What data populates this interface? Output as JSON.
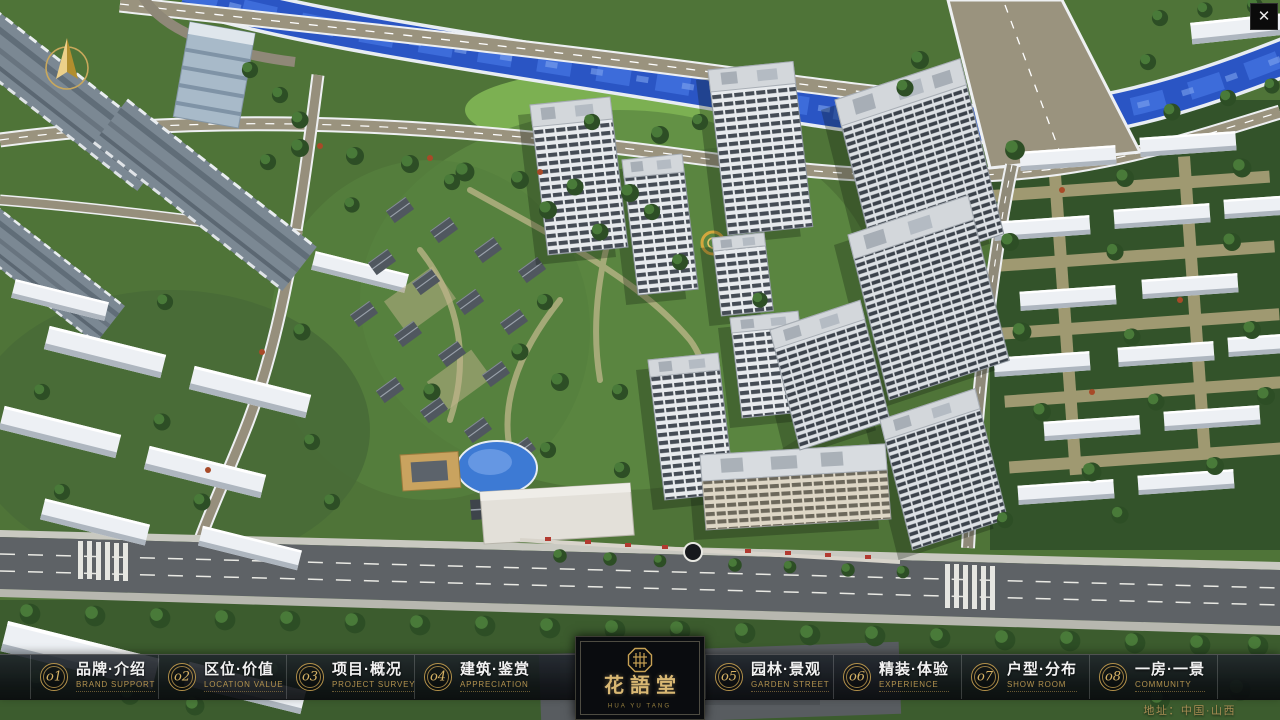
{
  "chrome": {
    "close_glyph": "✕"
  },
  "nav": {
    "items": [
      {
        "no": "o1",
        "label": "品牌·介绍",
        "caption": "BRAND SUPPORT"
      },
      {
        "no": "o2",
        "label": "区位·价值",
        "caption": "LOCATION VALUE"
      },
      {
        "no": "o3",
        "label": "项目·概况",
        "caption": "PROJECT SURVEY"
      },
      {
        "no": "o4",
        "label": "建筑·鉴赏",
        "caption": "APPRECIATION"
      },
      {
        "no": "o5",
        "label": "园林·景观",
        "caption": "GARDEN STREET"
      },
      {
        "no": "o6",
        "label": "精装·体验",
        "caption": "EXPERIENCE"
      },
      {
        "no": "o7",
        "label": "户型·分布",
        "caption": "SHOW ROOM"
      },
      {
        "no": "o8",
        "label": "一房·一景",
        "caption": "COMMUNITY"
      }
    ]
  },
  "logo": {
    "title": "花語堂",
    "subtitle": "HUA YU TANG"
  },
  "footer": {
    "address": "地址：中国·山西"
  },
  "colors": {
    "gold": "#c9a85c",
    "gold_dim": "#ab8c4e",
    "river": "#2a55c4",
    "bar_bg": "rgba(14,17,21,0.88)",
    "road": "#5e6266"
  }
}
